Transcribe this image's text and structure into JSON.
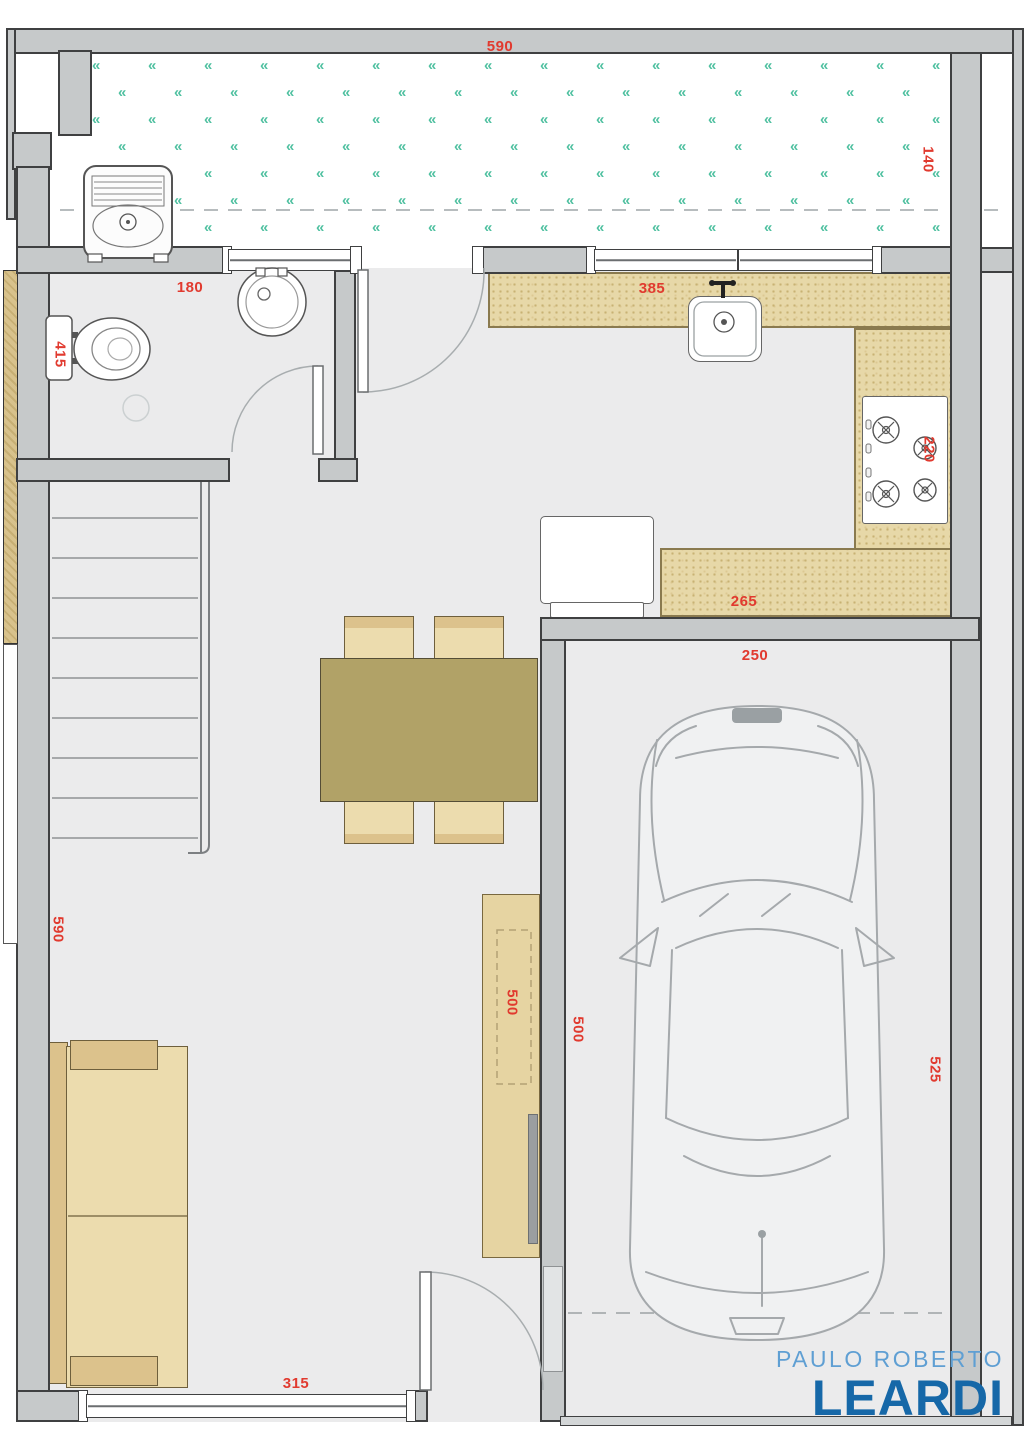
{
  "plan": {
    "title": "townhouse ground-floor plan",
    "areas": [
      "backyard",
      "bathroom",
      "corridor",
      "kitchen",
      "dining",
      "living",
      "stairs",
      "garage"
    ],
    "dimensions": [
      {
        "id": "yard-width",
        "value": "590",
        "orientation": "horizontal"
      },
      {
        "id": "yard-depth",
        "value": "140",
        "orientation": "vertical"
      },
      {
        "id": "bathroom-width",
        "value": "180",
        "orientation": "horizontal"
      },
      {
        "id": "bathroom-depth",
        "value": "415",
        "orientation": "vertical"
      },
      {
        "id": "kitchen-counter-top",
        "value": "385",
        "orientation": "horizontal"
      },
      {
        "id": "stove-counter",
        "value": "220",
        "orientation": "vertical"
      },
      {
        "id": "kitchen-counter-bottom",
        "value": "265",
        "orientation": "horizontal"
      },
      {
        "id": "garage-width",
        "value": "250",
        "orientation": "horizontal"
      },
      {
        "id": "living-depth",
        "value": "590",
        "orientation": "vertical"
      },
      {
        "id": "tv-rack-length",
        "value": "500",
        "orientation": "vertical"
      },
      {
        "id": "garage-wall-length",
        "value": "500",
        "orientation": "vertical"
      },
      {
        "id": "garage-depth",
        "value": "525",
        "orientation": "vertical"
      },
      {
        "id": "living-width",
        "value": "315",
        "orientation": "horizontal"
      }
    ],
    "fixtures": {
      "laundry_tub": "laundry-tub",
      "toilet": "toilet",
      "washbasin": "round-washbasin",
      "kitchen_sink": "kitchen-sink",
      "stove": "four-burner-cooktop",
      "refrigerator": "refrigerator",
      "dining_table": "dining-table-4-chairs",
      "sofa": "two-seat-sofa",
      "tv_rack": "tv-rack",
      "stairs": "staircase",
      "car": "car-top-view"
    }
  },
  "yard_pattern": {
    "glyph": "«",
    "color": "#4fc0a0"
  },
  "brand": {
    "line1": "PAULO ROBERTO",
    "line2": "LEARDI",
    "color_line1": "#5f9fd3",
    "color_line2": "#1668a8"
  },
  "colors": {
    "wall_fill": "#c6c9ca",
    "wall_outline": "#3f4041",
    "floor": "#ebebec",
    "counter": "#e7d8a8",
    "wood_light": "#ecdcae",
    "wood_dark": "#b1a267",
    "grass": "#4fc0a0",
    "dimension_text": "#e13a2f"
  }
}
